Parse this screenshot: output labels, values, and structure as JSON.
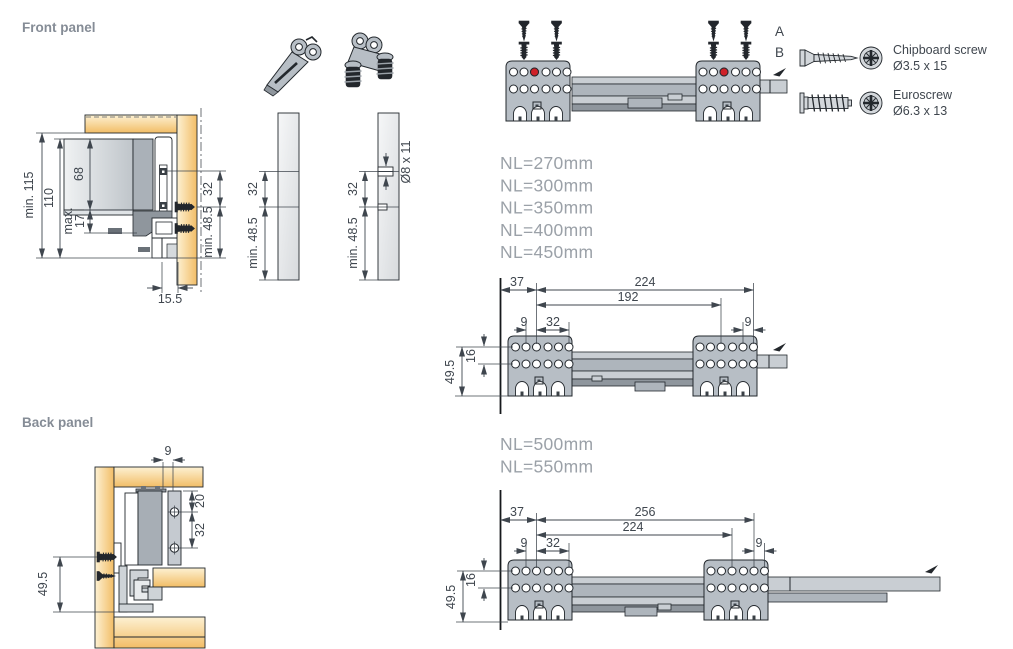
{
  "colors": {
    "accent_red": "#cf2128",
    "wood_tan": "#f3c06a",
    "metal_gray": "#b7bec5",
    "title_gray": "#858c96",
    "dim_text": "#3f464e"
  },
  "titles": {
    "front_panel": "Front panel",
    "back_panel": "Back panel"
  },
  "front_diagram": {
    "dim_min_115": "min. 115",
    "dim_110": "110",
    "dim_68": "68",
    "dim_max": "max.",
    "dim_17": "17",
    "dim_32": "32",
    "dim_min_485": "min. 48.5",
    "dim_155": "15.5"
  },
  "strip1": {
    "dim_32": "32",
    "dim_min_485": "min. 48.5"
  },
  "strip2": {
    "dim_32": "32",
    "dim_min_485": "min. 48.5",
    "dim_hole": "Ø8 x 11"
  },
  "assembly": {
    "label_a": "A",
    "label_b": "B"
  },
  "legend": {
    "chipboard_name": "Chipboard screw",
    "chipboard_size": "Ø3.5 x 15",
    "euroscrew_name": "Euroscrew",
    "euroscrew_size": "Ø6.3 x 13"
  },
  "lengths_short": {
    "items": [
      "NL=270mm",
      "NL=300mm",
      "NL=350mm",
      "NL=400mm",
      "NL=450mm"
    ]
  },
  "lengths_long": {
    "items": [
      "NL=500mm",
      "NL=550mm"
    ]
  },
  "drilling_short": {
    "dim_37": "37",
    "dim_224": "224",
    "dim_192": "192",
    "dim_9_left": "9",
    "dim_32": "32",
    "dim_9_right": "9",
    "dim_16": "16",
    "dim_495": "49.5"
  },
  "back_diagram": {
    "dim_9": "9",
    "dim_20": "20",
    "dim_32": "32",
    "dim_495": "49.5"
  },
  "drilling_long": {
    "dim_37": "37",
    "dim_256": "256",
    "dim_224": "224",
    "dim_9_left": "9",
    "dim_32": "32",
    "dim_9_right": "9",
    "dim_16": "16",
    "dim_495": "49.5"
  }
}
